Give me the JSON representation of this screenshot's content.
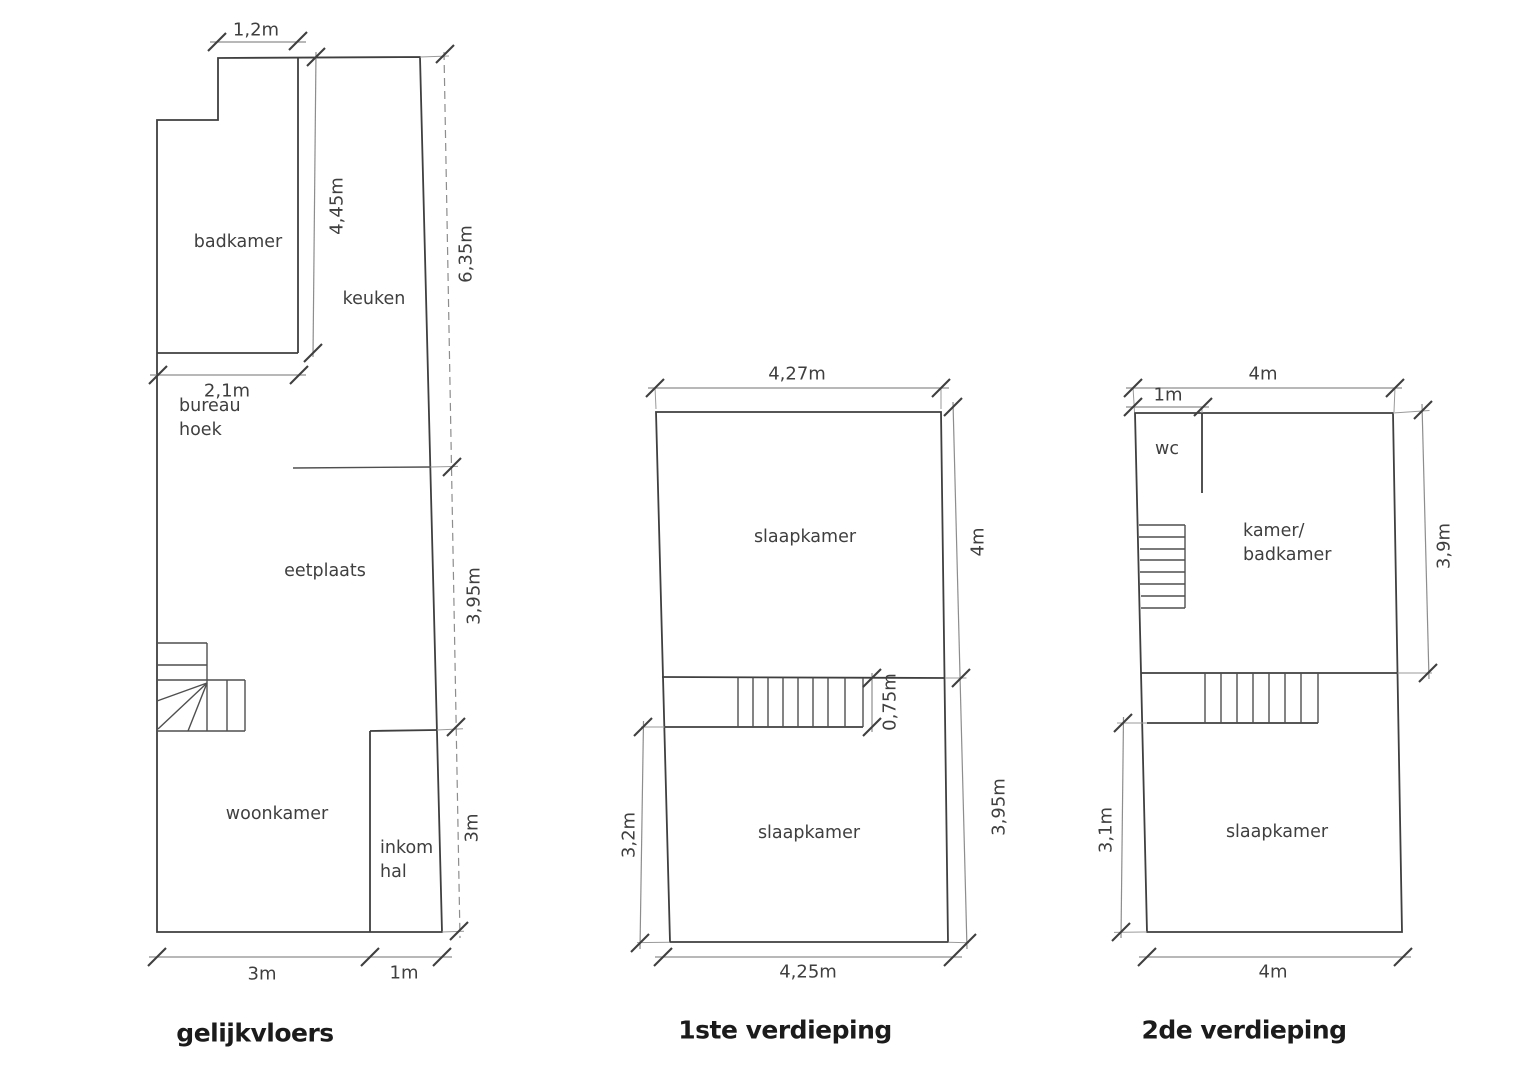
{
  "figure": {
    "background": "#ffffff",
    "wall_color": "#3f3f3f",
    "dimension_color": "#8d8d8d",
    "text_color": "#3f3f3f"
  },
  "ground": {
    "title": "gelijkvloers",
    "rooms": {
      "badkamer": "badkamer",
      "keuken": "keuken",
      "bureau_line1": "bureau",
      "bureau_line2": "hoek",
      "eetplaats": "eetplaats",
      "woonkamer": "woonkamer",
      "inkom_line1": "inkom",
      "inkom_line2": "hal"
    },
    "dims": {
      "notch_width": "1,2m",
      "kitchen_height": "4,45m",
      "right_upper": "6,35m",
      "badkamer_width": "2,1m",
      "right_middle": "3,95m",
      "right_lower": "3m",
      "bottom_main": "3m",
      "bottom_hall": "1m"
    }
  },
  "first": {
    "title": "1ste verdieping",
    "rooms": {
      "bedroom_upper": "slaapkamer",
      "bedroom_lower": "slaapkamer"
    },
    "dims": {
      "top": "4,27m",
      "right_upper": "4m",
      "stair_depth": "0,75m",
      "left": "3,2m",
      "right_lower": "3,95m",
      "bottom": "4,25m"
    }
  },
  "second": {
    "title": "2de verdieping",
    "rooms": {
      "wc": "wc",
      "kamer_line1": "kamer/",
      "kamer_line2": "badkamer",
      "bedroom": "slaapkamer"
    },
    "dims": {
      "top": "4m",
      "wc_width": "1m",
      "right": "3,9m",
      "left": "3,1m",
      "bottom": "4m"
    }
  }
}
